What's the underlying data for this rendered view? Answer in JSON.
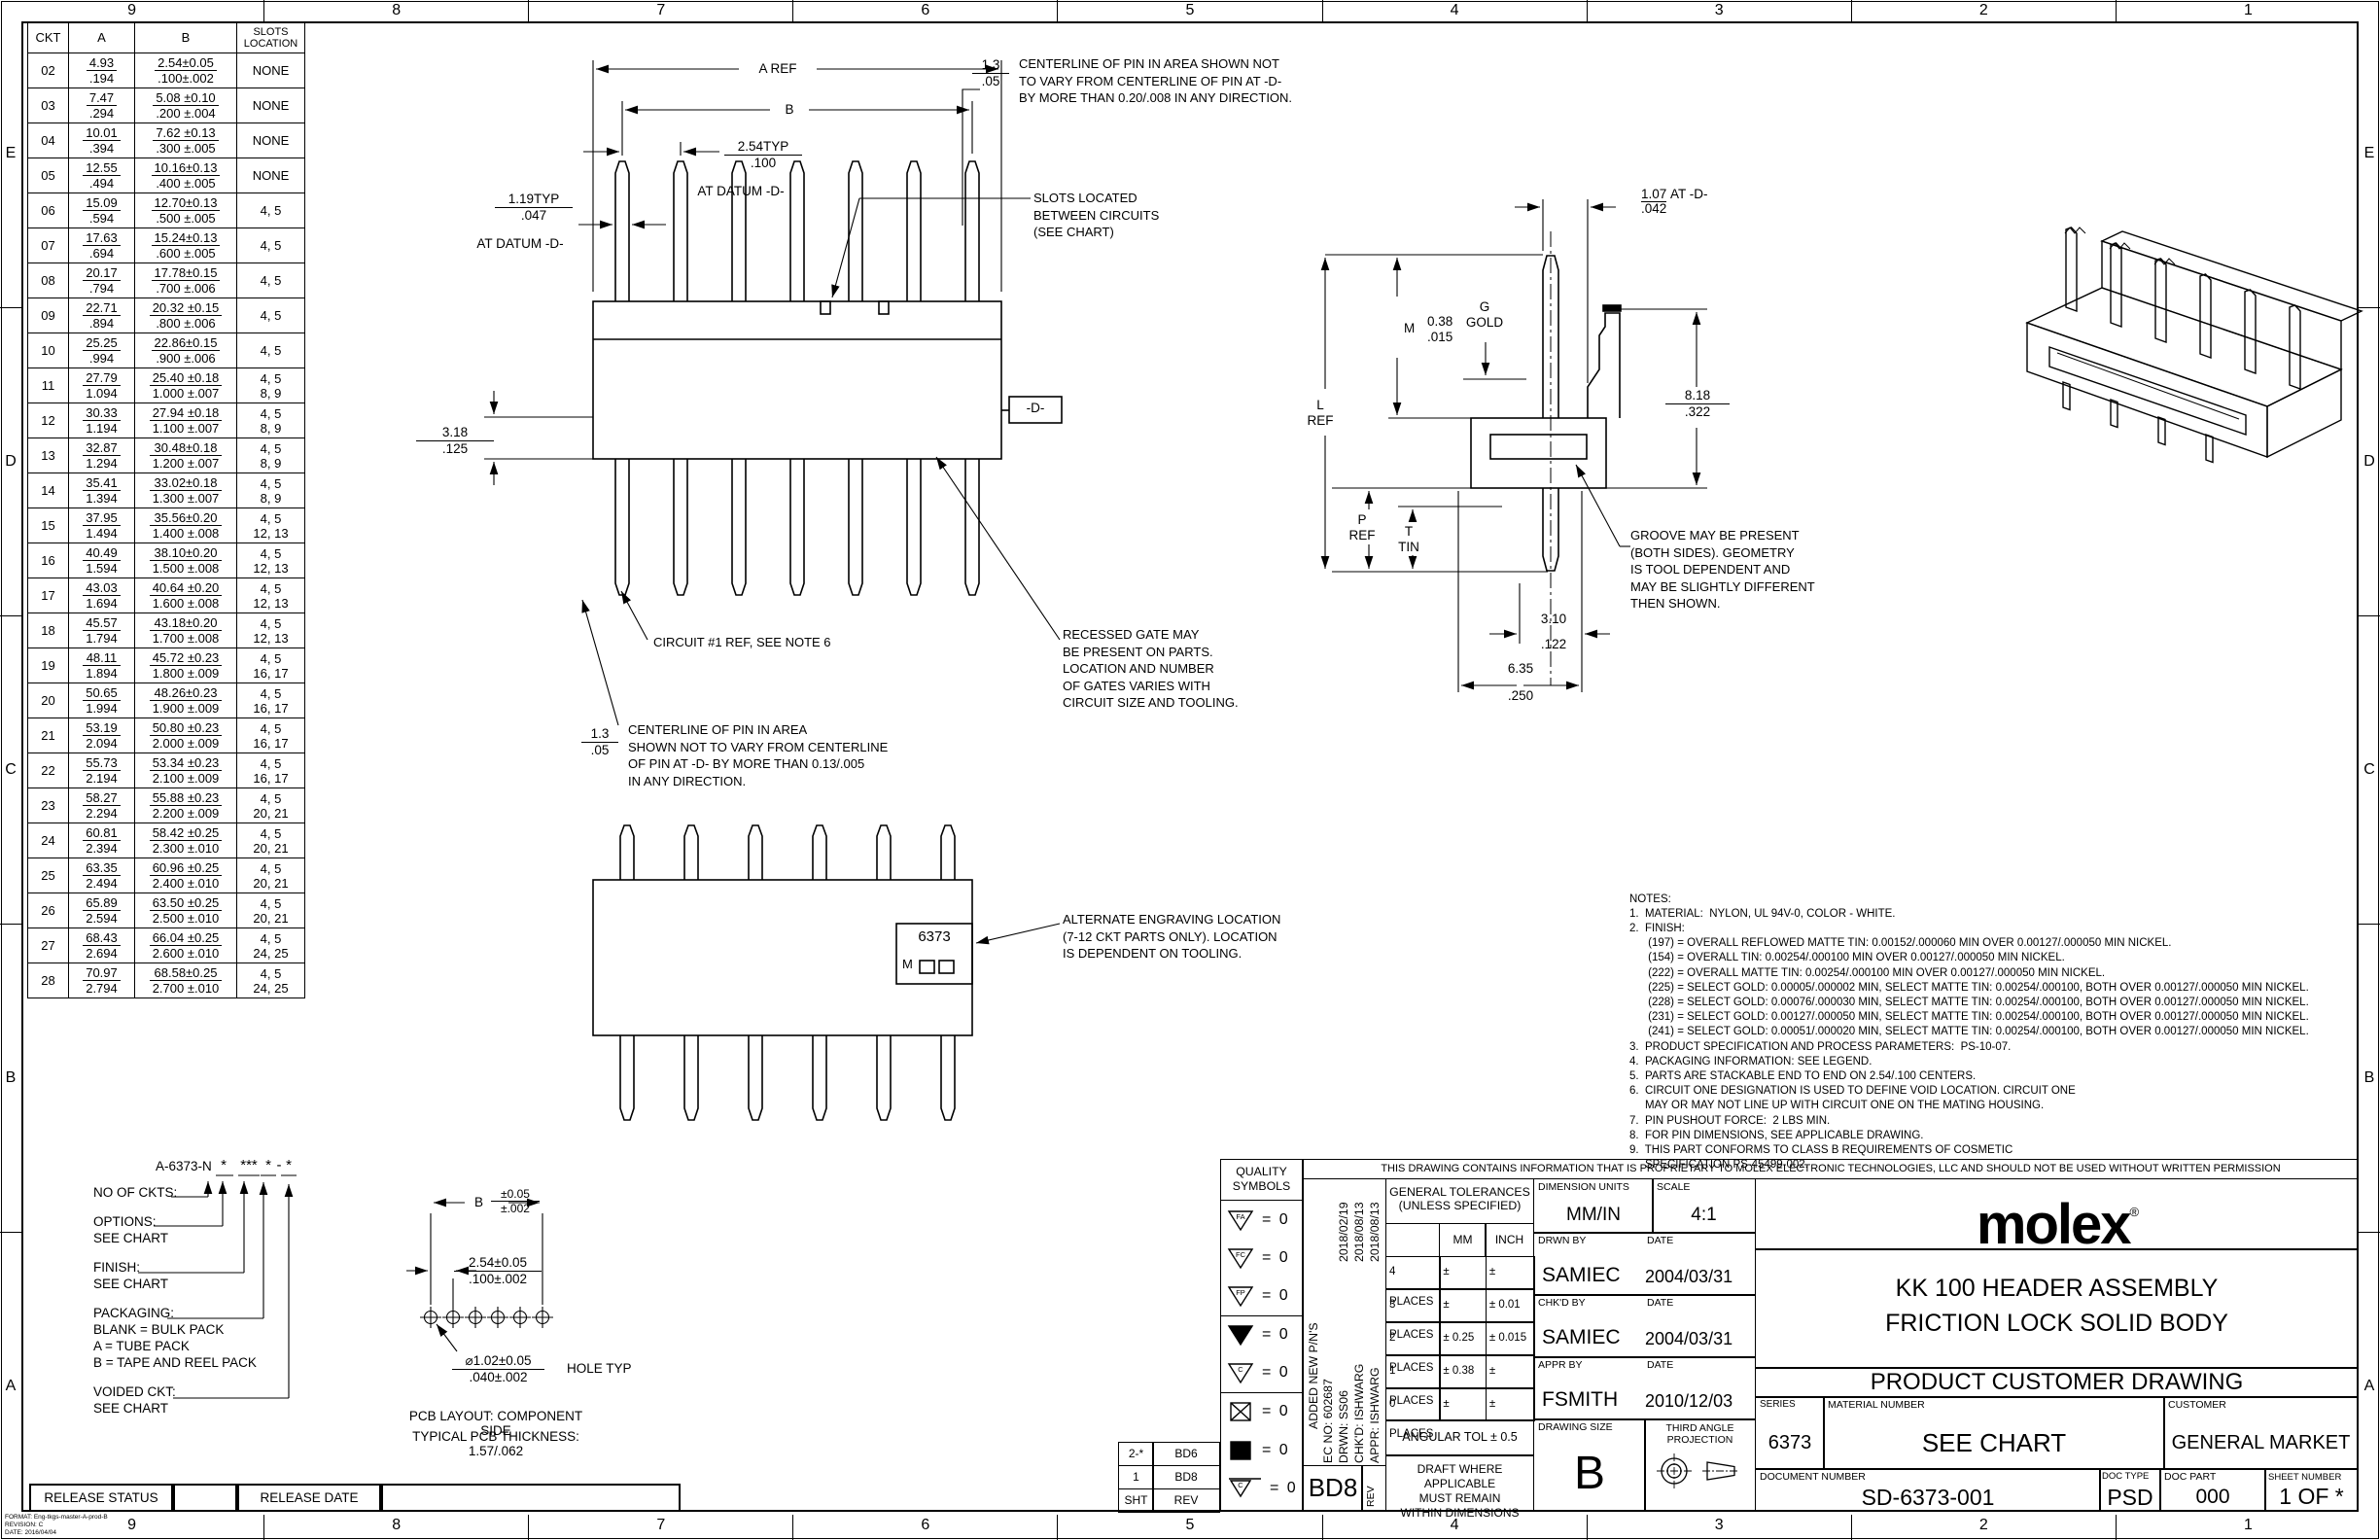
{
  "zones": {
    "columns": [
      "9",
      "8",
      "7",
      "6",
      "5",
      "4",
      "3",
      "2",
      "1"
    ],
    "rows": [
      "E",
      "D",
      "C",
      "B",
      "A"
    ]
  },
  "table": {
    "headers": {
      "ckt": "CKT",
      "a": "A",
      "b": "B",
      "slots": "SLOTS\nLOCATION"
    },
    "rows": [
      {
        "ckt": "02",
        "a_mm": "4.93",
        "a_in": ".194",
        "b_mm": "2.54±0.05",
        "b_in": ".100±.002",
        "slots": "NONE"
      },
      {
        "ckt": "03",
        "a_mm": "7.47",
        "a_in": ".294",
        "b_mm": "5.08 ±0.10",
        "b_in": ".200 ±.004",
        "slots": "NONE"
      },
      {
        "ckt": "04",
        "a_mm": "10.01",
        "a_in": ".394",
        "b_mm": "7.62 ±0.13",
        "b_in": ".300 ±.005",
        "slots": "NONE"
      },
      {
        "ckt": "05",
        "a_mm": "12.55",
        "a_in": ".494",
        "b_mm": "10.16±0.13",
        "b_in": ".400 ±.005",
        "slots": "NONE"
      },
      {
        "ckt": "06",
        "a_mm": "15.09",
        "a_in": ".594",
        "b_mm": "12.70±0.13",
        "b_in": ".500 ±.005",
        "slots": "4, 5"
      },
      {
        "ckt": "07",
        "a_mm": "17.63",
        "a_in": ".694",
        "b_mm": "15.24±0.13",
        "b_in": ".600 ±.005",
        "slots": "4, 5"
      },
      {
        "ckt": "08",
        "a_mm": "20.17",
        "a_in": ".794",
        "b_mm": "17.78±0.15",
        "b_in": ".700 ±.006",
        "slots": "4, 5"
      },
      {
        "ckt": "09",
        "a_mm": "22.71",
        "a_in": ".894",
        "b_mm": "20.32 ±0.15",
        "b_in": ".800 ±.006",
        "slots": "4, 5"
      },
      {
        "ckt": "10",
        "a_mm": "25.25",
        "a_in": ".994",
        "b_mm": "22.86±0.15",
        "b_in": ".900 ±.006",
        "slots": "4, 5"
      },
      {
        "ckt": "11",
        "a_mm": "27.79",
        "a_in": "1.094",
        "b_mm": "25.40 ±0.18",
        "b_in": "1.000 ±.007",
        "slots": "4, 5\n8, 9"
      },
      {
        "ckt": "12",
        "a_mm": "30.33",
        "a_in": "1.194",
        "b_mm": "27.94 ±0.18",
        "b_in": "1.100 ±.007",
        "slots": "4, 5\n8, 9"
      },
      {
        "ckt": "13",
        "a_mm": "32.87",
        "a_in": "1.294",
        "b_mm": "30.48±0.18",
        "b_in": "1.200 ±.007",
        "slots": "4, 5\n8, 9"
      },
      {
        "ckt": "14",
        "a_mm": "35.41",
        "a_in": "1.394",
        "b_mm": "33.02±0.18",
        "b_in": "1.300 ±.007",
        "slots": "4, 5\n8, 9"
      },
      {
        "ckt": "15",
        "a_mm": "37.95",
        "a_in": "1.494",
        "b_mm": "35.56±0.20",
        "b_in": "1.400 ±.008",
        "slots": "4, 5\n12, 13"
      },
      {
        "ckt": "16",
        "a_mm": "40.49",
        "a_in": "1.594",
        "b_mm": "38.10±0.20",
        "b_in": "1.500 ±.008",
        "slots": "4, 5\n12, 13"
      },
      {
        "ckt": "17",
        "a_mm": "43.03",
        "a_in": "1.694",
        "b_mm": "40.64 ±0.20",
        "b_in": "1.600 ±.008",
        "slots": "4, 5\n12, 13"
      },
      {
        "ckt": "18",
        "a_mm": "45.57",
        "a_in": "1.794",
        "b_mm": "43.18±0.20",
        "b_in": "1.700 ±.008",
        "slots": "4, 5\n12, 13"
      },
      {
        "ckt": "19",
        "a_mm": "48.11",
        "a_in": "1.894",
        "b_mm": "45.72 ±0.23",
        "b_in": "1.800 ±.009",
        "slots": "4, 5\n16, 17"
      },
      {
        "ckt": "20",
        "a_mm": "50.65",
        "a_in": "1.994",
        "b_mm": "48.26±0.23",
        "b_in": "1.900 ±.009",
        "slots": "4, 5\n16, 17"
      },
      {
        "ckt": "21",
        "a_mm": "53.19",
        "a_in": "2.094",
        "b_mm": "50.80 ±0.23",
        "b_in": "2.000 ±.009",
        "slots": "4, 5\n16, 17"
      },
      {
        "ckt": "22",
        "a_mm": "55.73",
        "a_in": "2.194",
        "b_mm": "53.34 ±0.23",
        "b_in": "2.100 ±.009",
        "slots": "4, 5\n16, 17"
      },
      {
        "ckt": "23",
        "a_mm": "58.27",
        "a_in": "2.294",
        "b_mm": "55.88 ±0.23",
        "b_in": "2.200 ±.009",
        "slots": "4, 5\n20, 21"
      },
      {
        "ckt": "24",
        "a_mm": "60.81",
        "a_in": "2.394",
        "b_mm": "58.42 ±0.25",
        "b_in": "2.300 ±.010",
        "slots": "4, 5\n20, 21"
      },
      {
        "ckt": "25",
        "a_mm": "63.35",
        "a_in": "2.494",
        "b_mm": "60.96 ±0.25",
        "b_in": "2.400 ±.010",
        "slots": "4, 5\n20, 21"
      },
      {
        "ckt": "26",
        "a_mm": "65.89",
        "a_in": "2.594",
        "b_mm": "63.50 ±0.25",
        "b_in": "2.500 ±.010",
        "slots": "4, 5\n20, 21"
      },
      {
        "ckt": "27",
        "a_mm": "68.43",
        "a_in": "2.694",
        "b_mm": "66.04 ±0.25",
        "b_in": "2.600 ±.010",
        "slots": "4, 5\n24, 25"
      },
      {
        "ckt": "28",
        "a_mm": "70.97",
        "a_in": "2.794",
        "b_mm": "68.58±0.25",
        "b_in": "2.700 ±.010",
        "slots": "4, 5\n24, 25"
      }
    ]
  },
  "front": {
    "a_ref": "A REF",
    "b": "B",
    "pitch_mm": "2.54TYP",
    "pitch_in": ".100",
    "pitch_at": "AT DATUM -D-",
    "pinw_mm": "1.19TYP",
    "pinw_in": ".047",
    "pinw_at": "AT DATUM -D-",
    "tail_mm": "3.18",
    "tail_in": ".125",
    "datum": "-D-",
    "note_top_mm": "1.3",
    "note_top_in": ".05",
    "note_top": "CENTERLINE OF PIN IN AREA SHOWN NOT\nTO VARY FROM CENTERLINE OF PIN AT -D-\nBY MORE THAN 0.20/.008 IN ANY DIRECTION.",
    "note_slots": "SLOTS LOCATED\nBETWEEN CIRCUITS\n(SEE CHART)",
    "note_circuit1": "CIRCUIT #1 REF, SEE NOTE 6",
    "note_gate": "RECESSED GATE MAY\nBE PRESENT ON PARTS.\nLOCATION AND NUMBER\nOF GATES VARIES WITH\nCIRCUIT SIZE AND TOOLING.",
    "note_bot_mm": "1.3",
    "note_bot_in": ".05",
    "note_bot": "CENTERLINE OF PIN IN AREA\nSHOWN NOT TO VARY FROM CENTERLINE\nOF PIN AT -D- BY MORE THAN 0.13/.005\nIN ANY DIRECTION."
  },
  "section": {
    "offset_mm": "1.07",
    "offset_at": "AT -D-",
    "offset_in": ".042",
    "m": "M",
    "m_mm": "0.38",
    "m_in": ".015",
    "g": "G\nGOLD",
    "l": "L\nREF",
    "h_mm": "8.18",
    "h_in": ".322",
    "p": "P\nREF",
    "t": "T\nTIN",
    "slot_mm": "3.10",
    "slot_in": ".122",
    "base_mm": "6.35",
    "base_in": ".250",
    "groove": "GROOVE MAY BE PRESENT\n(BOTH SIDES). GEOMETRY\nIS TOOL DEPENDENT AND\nMAY BE SLIGHTLY DIFFERENT\nTHEN SHOWN."
  },
  "lower": {
    "marking": "6373",
    "marking2": "M",
    "note_engraving": "ALTERNATE ENGRAVING LOCATION\n(7-12 CKT PARTS ONLY).  LOCATION\nIS DEPENDENT ON TOOLING."
  },
  "legend": {
    "part_number": "A-6373-N",
    "stars": [
      "*",
      "***",
      "*",
      "-",
      "*"
    ],
    "items": [
      {
        "label": "NO OF CKTS:",
        "sub": ""
      },
      {
        "label": "OPTIONS:",
        "sub": "SEE CHART"
      },
      {
        "label": "FINISH:",
        "sub": "SEE CHART"
      },
      {
        "label": "PACKAGING:",
        "sub": "BLANK = BULK PACK\nA = TUBE PACK\nB  = TAPE AND REEL PACK"
      },
      {
        "label": "VOIDED CKT:",
        "sub": "SEE CHART"
      }
    ]
  },
  "pcb": {
    "b": "B",
    "b_mm": "±0.05",
    "b_in": "±.002",
    "pitch_mm": "2.54±0.05",
    "pitch_in": ".100±.002",
    "hole_mm": "⌀1.02±0.05",
    "hole_in": ".040±.002",
    "hole_label": "HOLE TYP",
    "line1": "PCB LAYOUT: COMPONENT SIDE",
    "line2": "TYPICAL PCB THICKNESS: 1.57/.062"
  },
  "notes": {
    "lines": [
      "NOTES:",
      "1.  MATERIAL:  NYLON, UL 94V-0, COLOR - WHITE.",
      "2.  FINISH:",
      "      (197) = OVERALL REFLOWED MATTE TIN: 0.00152/.000060 MIN OVER 0.00127/.000050 MIN NICKEL.",
      "      (154) = OVERALL TIN: 0.00254/.000100 MIN OVER 0.00127/.000050 MIN NICKEL.",
      "      (222) = OVERALL MATTE TIN: 0.00254/.000100 MIN OVER 0.00127/.000050 MIN NICKEL.",
      "      (225) = SELECT GOLD: 0.00005/.000002 MIN, SELECT MATTE TIN: 0.00254/.000100, BOTH OVER 0.00127/.000050 MIN NICKEL.",
      "      (228) = SELECT GOLD: 0.00076/.000030 MIN, SELECT MATTE TIN: 0.00254/.000100, BOTH OVER 0.00127/.000050 MIN NICKEL.",
      "      (231) = SELECT GOLD: 0.00127/.000050 MIN, SELECT MATTE TIN: 0.00254/.000100, BOTH OVER 0.00127/.000050 MIN NICKEL.",
      "      (241) = SELECT GOLD: 0.00051/.000020 MIN, SELECT MATTE TIN: 0.00254/.000100, BOTH OVER 0.00127/.000050 MIN NICKEL.",
      "3.  PRODUCT SPECIFICATION AND PROCESS PARAMETERS:  PS-10-07.",
      "4.  PACKAGING INFORMATION: SEE LEGEND.",
      "5.  PARTS ARE STACKABLE END TO END ON 2.54/.100 CENTERS.",
      "6.  CIRCUIT ONE DESIGNATION IS USED TO DEFINE VOID LOCATION. CIRCUIT ONE",
      "     MAY OR MAY NOT LINE UP WITH CIRCUIT ONE ON THE MATING HOUSING.",
      "7.  PIN PUSHOUT FORCE:  2 LBS MIN.",
      "8.  FOR PIN DIMENSIONS, SEE APPLICABLE DRAWING.",
      "9.  THIS PART CONFORMS TO CLASS B REQUIREMENTS OF COSMETIC",
      "     SPECIFICATION PS-45499-002."
    ]
  },
  "quality": {
    "header": "QUALITY\nSYMBOLS",
    "rows": [
      {
        "letter": "FA",
        "value": "=  0"
      },
      {
        "letter": "FC",
        "value": "=  0"
      },
      {
        "letter": "FP",
        "value": "=  0"
      },
      {
        "letter": "",
        "value": "=  0"
      },
      {
        "letter": "C",
        "value": "=  0"
      },
      {
        "letter": "",
        "value": "=  0"
      },
      {
        "letter": "",
        "value": "=  0"
      },
      {
        "letter": "C",
        "value": "=  0"
      }
    ]
  },
  "title_block": {
    "proprietary": "THIS DRAWING CONTAINS INFORMATION THAT IS PROPRIETARY TO MOLEX ELECTRONIC TECHNOLOGIES, LLC AND SHOULD NOT BE USED WITHOUT WRITTEN PERMISSION",
    "ec": {
      "added": "ADDED NEW P/N'S",
      "ec_no": "EC NO:  602687",
      "drwn": "DRWN:  SS06",
      "chkd": "CHK'D:  ISHWARG",
      "appr": "APPR:  ISHWARG",
      "date1": "2018/02/19",
      "date2": "2018/08/13",
      "date3": "2018/08/13",
      "rev": "BD8",
      "rev_lbl": "REV"
    },
    "tol": {
      "header1": "GENERAL TOLERANCES",
      "header2": "(UNLESS SPECIFIED)",
      "col_mm": "MM",
      "col_inch": "INCH",
      "rows": [
        [
          "4 PLACES",
          "±",
          "±"
        ],
        [
          "3 PLACES",
          "±",
          "±  0.01"
        ],
        [
          "2 PLACES",
          "±  0.25",
          "±  0.015"
        ],
        [
          "1 PLACES",
          "±  0.38",
          "±"
        ],
        [
          "0 PLACES",
          "±",
          "±"
        ]
      ],
      "angular": "ANGULAR TOL ±  0.5",
      "draft": "DRAFT WHERE APPLICABLE\nMUST REMAIN\nWITHIN DIMENSIONS"
    },
    "units_lbl": "DIMENSION UNITS",
    "units": "MM/IN",
    "scale_lbl": "SCALE",
    "scale": "4:1",
    "drwn_lbl": "DRWN BY",
    "drwn": "SAMIEC",
    "drwn_date_lbl": "DATE",
    "drwn_date": "2004/03/31",
    "chkd_lbl": "CHK'D BY",
    "chkd": "SAMIEC",
    "chkd_date_lbl": "DATE",
    "chkd_date": "2004/03/31",
    "appr_lbl": "APPR BY",
    "appr": "FSMITH",
    "appr_date_lbl": "DATE",
    "appr_date": "2010/12/03",
    "size_lbl": "DRAWING SIZE",
    "size": "B",
    "proj_lbl": "THIRD ANGLE PROJECTION",
    "logo": "molex",
    "logo_reg": "®",
    "title1": "KK 100 HEADER ASSEMBLY",
    "title2": "FRICTION LOCK SOLID BODY",
    "doc_kind": "PRODUCT CUSTOMER DRAWING",
    "series_lbl": "SERIES",
    "series": "6373",
    "material_lbl": "MATERIAL NUMBER",
    "material": "SEE CHART",
    "customer_lbl": "CUSTOMER",
    "customer": "GENERAL MARKET",
    "docnum_lbl": "DOCUMENT NUMBER",
    "docnum": "SD-6373-001",
    "doctype_lbl": "DOC TYPE",
    "doctype": "PSD",
    "docpart_lbl": "DOC PART",
    "docpart": "000",
    "sheet_lbl": "SHEET NUMBER",
    "sheet": "1 OF *"
  },
  "rev_table": {
    "rows": [
      [
        "2-*",
        "BD6"
      ],
      [
        "1",
        "BD8"
      ],
      [
        "SHT",
        "REV"
      ]
    ]
  },
  "release_bar": {
    "status": "RELEASE STATUS",
    "date": "RELEASE DATE"
  },
  "footer": {
    "line1": "FORMAT: Eng-tkgs-master-A-prod-B",
    "line2": "REVISION: C",
    "line3": "DATE: 2016/04/04"
  }
}
